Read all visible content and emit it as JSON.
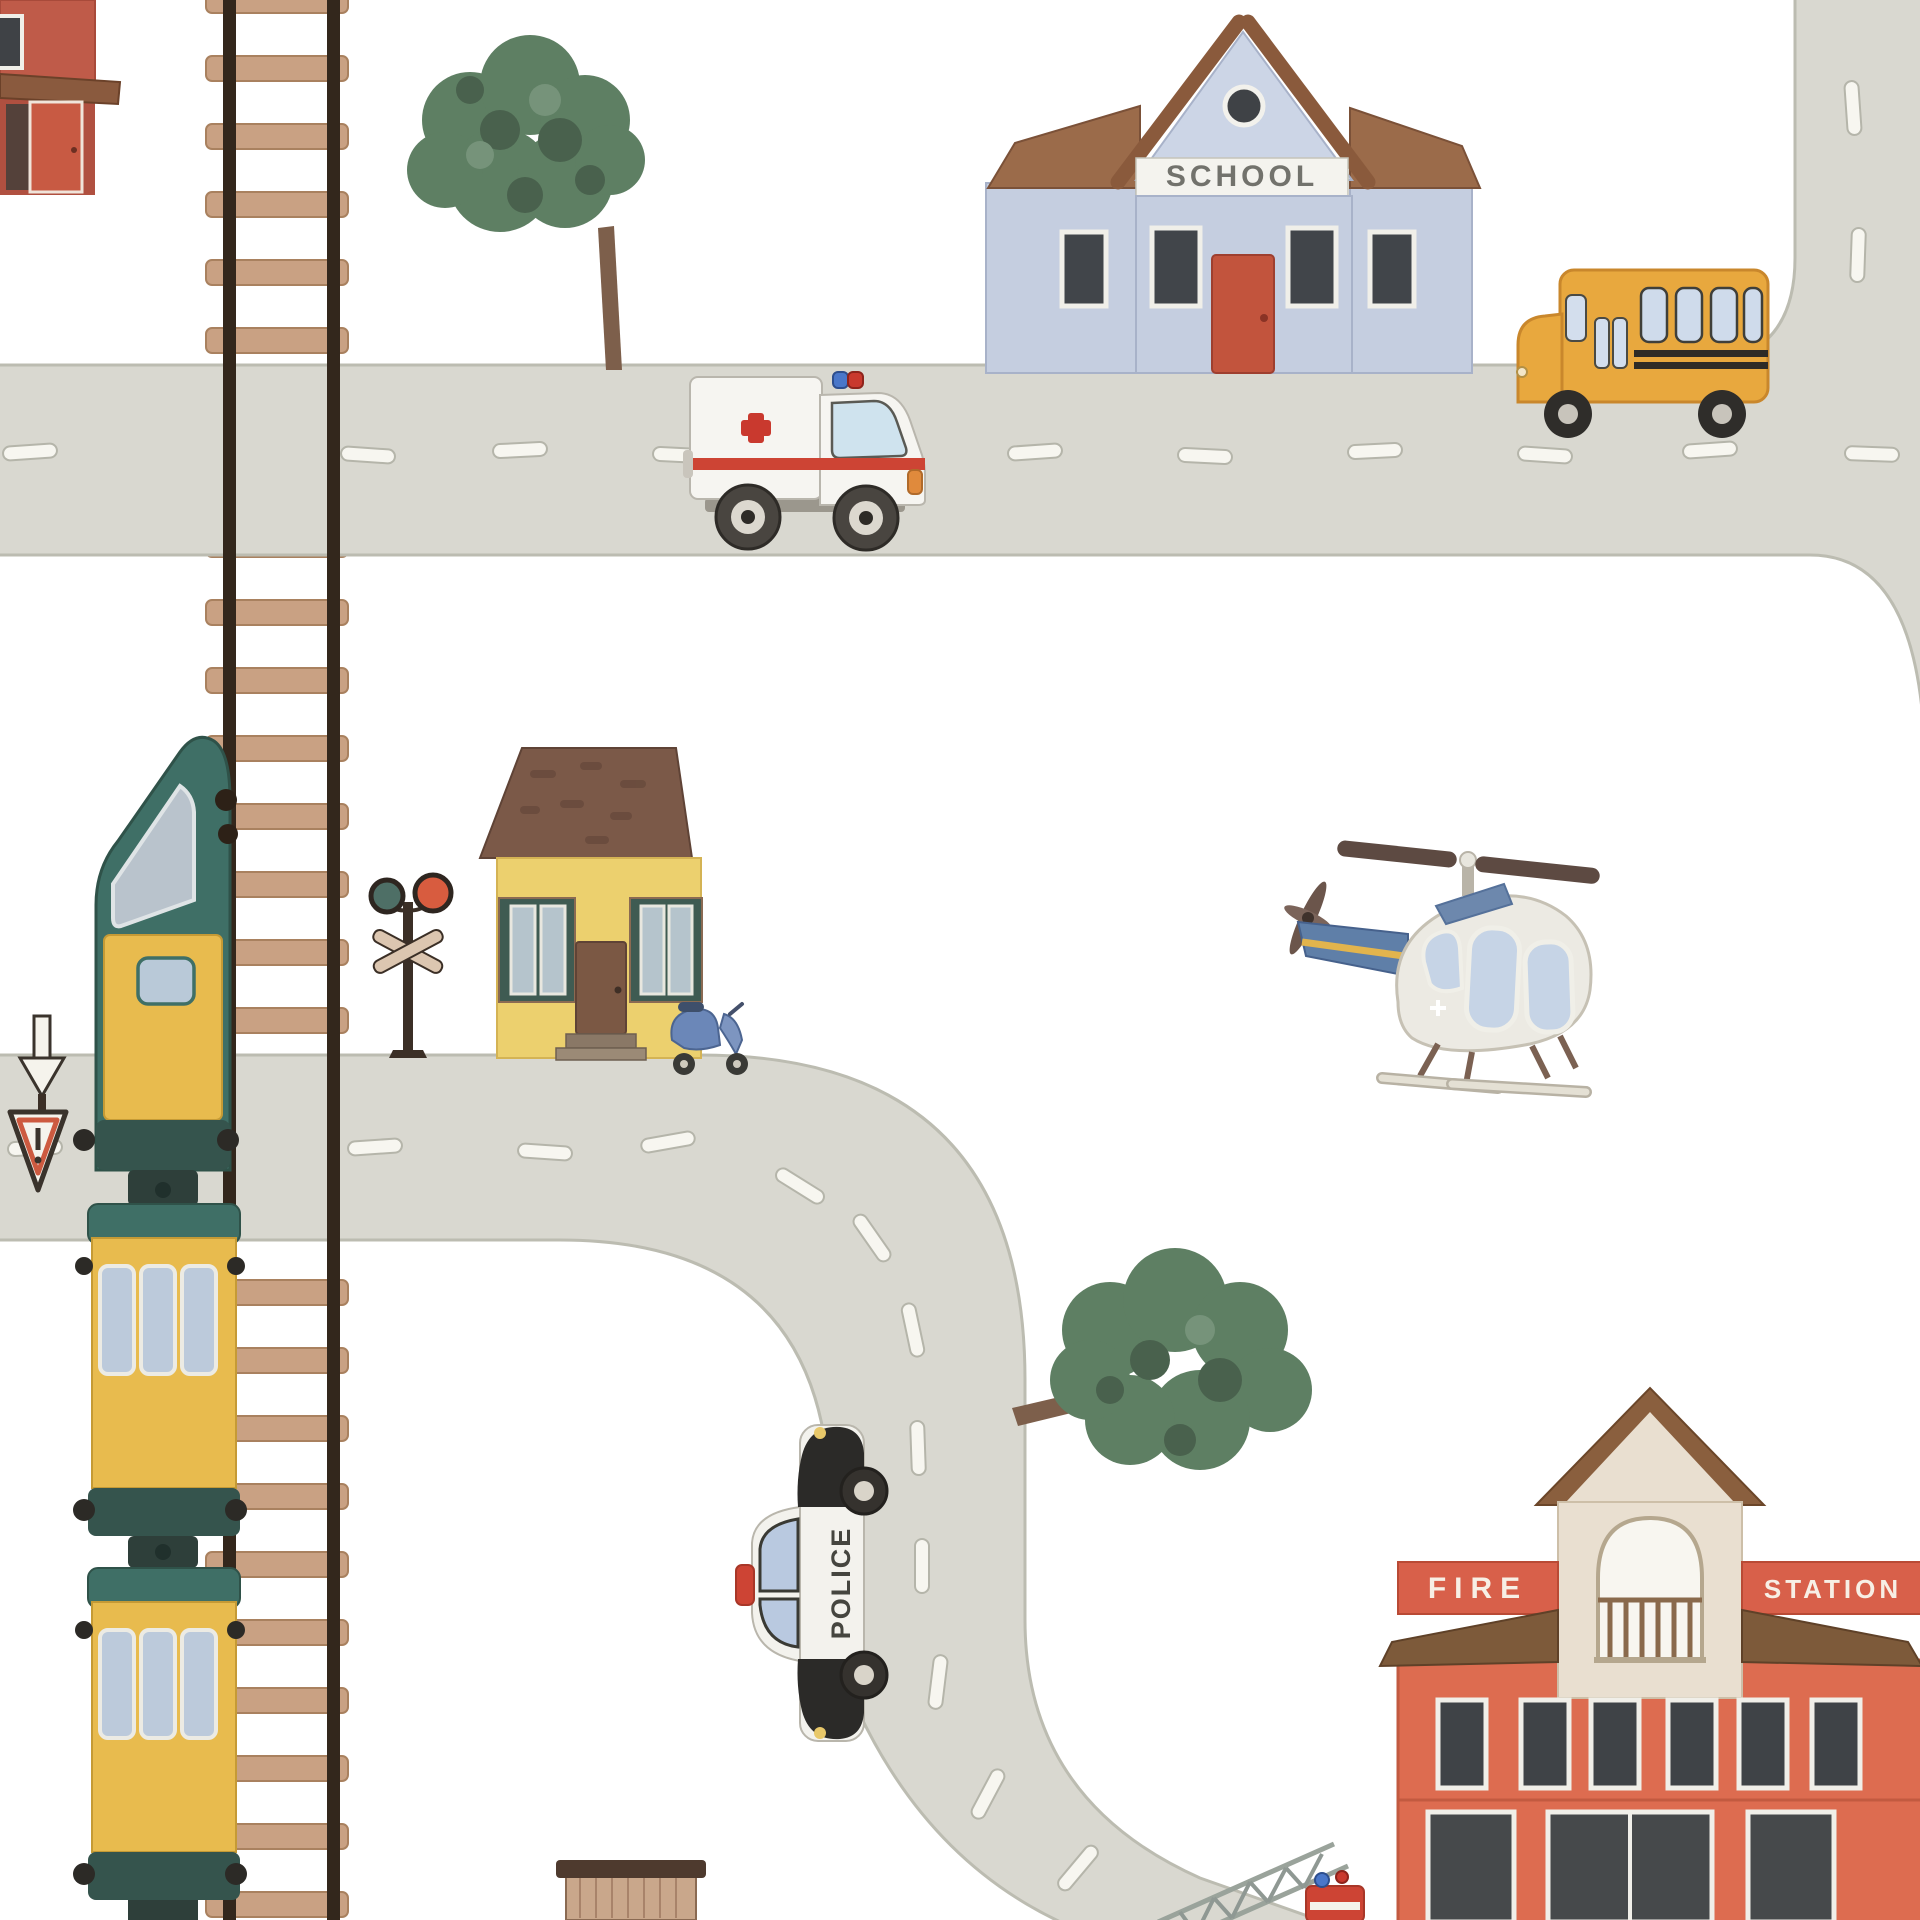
{
  "scene": {
    "description": "Watercolor children's city road-map illustration with railroad, train, roads, vehicles and buildings",
    "school": {
      "sign": "SCHOOL"
    },
    "fire_station": {
      "sign_left": "FIRE",
      "sign_right": "STATION"
    },
    "police_car": {
      "label": "POLICE"
    },
    "objects": [
      "corner-building",
      "railroad-track",
      "train",
      "top-road",
      "right-road",
      "middle-road",
      "school-building",
      "school-bus",
      "ambulance",
      "round-tree",
      "yellow-house",
      "scooter",
      "railroad-crossing-signal",
      "down-arrow-sign",
      "warning-triangle-sign",
      "helicopter",
      "police-car",
      "leafy-tree",
      "fire-station",
      "fire-truck-ladder",
      "wooden-shed"
    ],
    "colors": {
      "background": "#ffffff",
      "road": "#d9d8d0",
      "road_dash": "#f7f6f0",
      "rail": "#33271c",
      "tie": "#c9a183",
      "school_wall": "#c5cee0",
      "roof_brown": "#9b6b4a",
      "door_red": "#c2543d",
      "bus_yellow": "#e8a83e",
      "ambulance_white": "#f6f5f1",
      "cross_red": "#c9392e",
      "train_teal": "#3f6f66",
      "train_yellow": "#e8bb4e",
      "house_yellow": "#ecd06e",
      "shutter_green": "#3f5b52",
      "tree_green": "#5e7f63",
      "trunk_brown": "#7d5f4b",
      "fire_red": "#dd6c50",
      "tower_beige": "#e9dfd0",
      "heli_body": "#eceae3",
      "heli_tail": "#5f7fa8",
      "scooter_blue": "#6b87b8",
      "police_black": "#2b2a28",
      "signal_red": "#d85c3f",
      "signal_teal": "#4e6f66"
    }
  }
}
